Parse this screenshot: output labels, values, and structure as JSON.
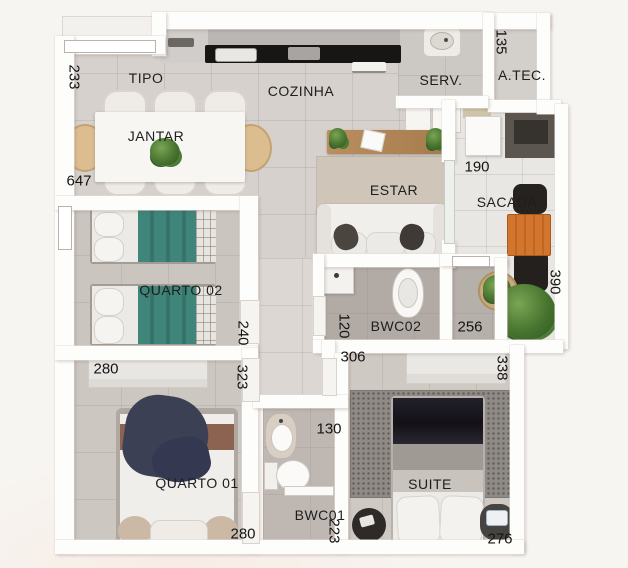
{
  "rooms": {
    "tipo": "TIPO",
    "cozinha": "COZINHA",
    "serv": "SERV.",
    "atec": "A.TEC.",
    "jantar": "JANTAR",
    "estar": "ESTAR",
    "sacada": "SACADA",
    "quarto02": "QUARTO 02",
    "bwc02": "BWC02",
    "quarto01": "QUARTO 01",
    "bwc01": "BWC01",
    "suite": "SUITE"
  },
  "dims": {
    "d233": "233",
    "d647": "647",
    "d135": "135",
    "d190": "190",
    "d390": "390",
    "d240": "240",
    "d280_top": "280",
    "d323": "323",
    "d120": "120",
    "d256": "256",
    "d306": "306",
    "d338": "338",
    "d130": "130",
    "d223": "223",
    "d280_bottom": "280",
    "d276": "276"
  },
  "colors": {
    "wall": "#fdfdfc",
    "floor_social": "#d6d1cd",
    "floor_sacada": "#e9e7e4",
    "teal_bed": "#3f857a",
    "wood_console": "#b98f60",
    "orange_table": "#d2752f",
    "navy_blanket": "#3c4054",
    "counter_black": "#171614"
  }
}
